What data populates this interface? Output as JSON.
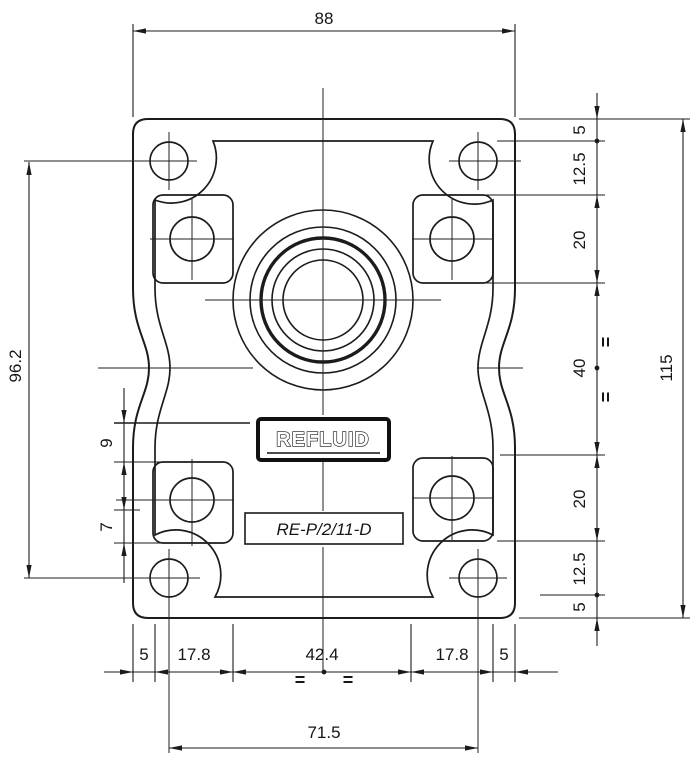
{
  "drawing": {
    "title": "Pump flange dimensional drawing",
    "logo": "REFLUID",
    "model": "RE-P/2/11-D",
    "dims": {
      "top_width": "88",
      "bottom_row": [
        "5",
        "17.8",
        "42.4",
        "17.8",
        "5"
      ],
      "bottom_total": "71.5",
      "right_column": [
        "5",
        "12.5",
        "20",
        "40",
        "20",
        "12.5",
        "5"
      ],
      "right_total": "115",
      "left_span": "96.2",
      "step_upper": "9",
      "step_lower": "7",
      "eq": "="
    },
    "colors": {
      "line": "#1b1b1b",
      "background": "#ffffff"
    }
  }
}
